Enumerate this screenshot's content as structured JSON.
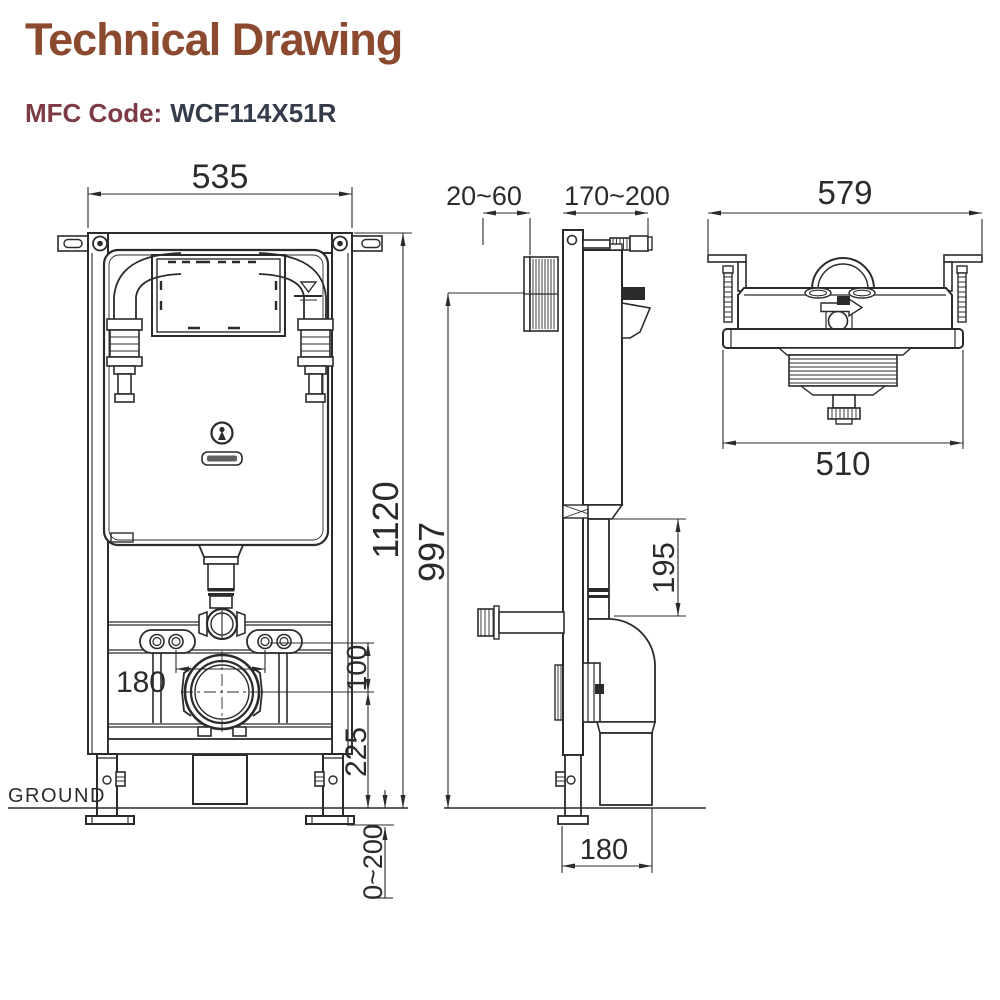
{
  "title": "Technical Drawing",
  "mfc_label": "MFC Code:",
  "mfc_code": "WCF114X51R",
  "colors": {
    "title": "#8B4A30",
    "mfc_label": "#7C3B45",
    "mfc_code": "#343B49",
    "line": "#2B2B2B",
    "background": "#FFFFFF"
  },
  "front_view": {
    "width_mm": "535",
    "height_mm": "1120",
    "fixing_spacing_mm": "180",
    "outlet_offset_mm": "100",
    "outlet_height_mm": "225",
    "foot_range_mm": "0~200",
    "ground_label": "GROUND"
  },
  "side_view": {
    "plate_range_mm": "20~60",
    "depth_range_mm": "170~200",
    "height_mm": "997",
    "outlet_drop_mm": "195",
    "base_depth_mm": "180"
  },
  "top_view": {
    "overall_width_mm": "579",
    "body_width_mm": "510"
  }
}
